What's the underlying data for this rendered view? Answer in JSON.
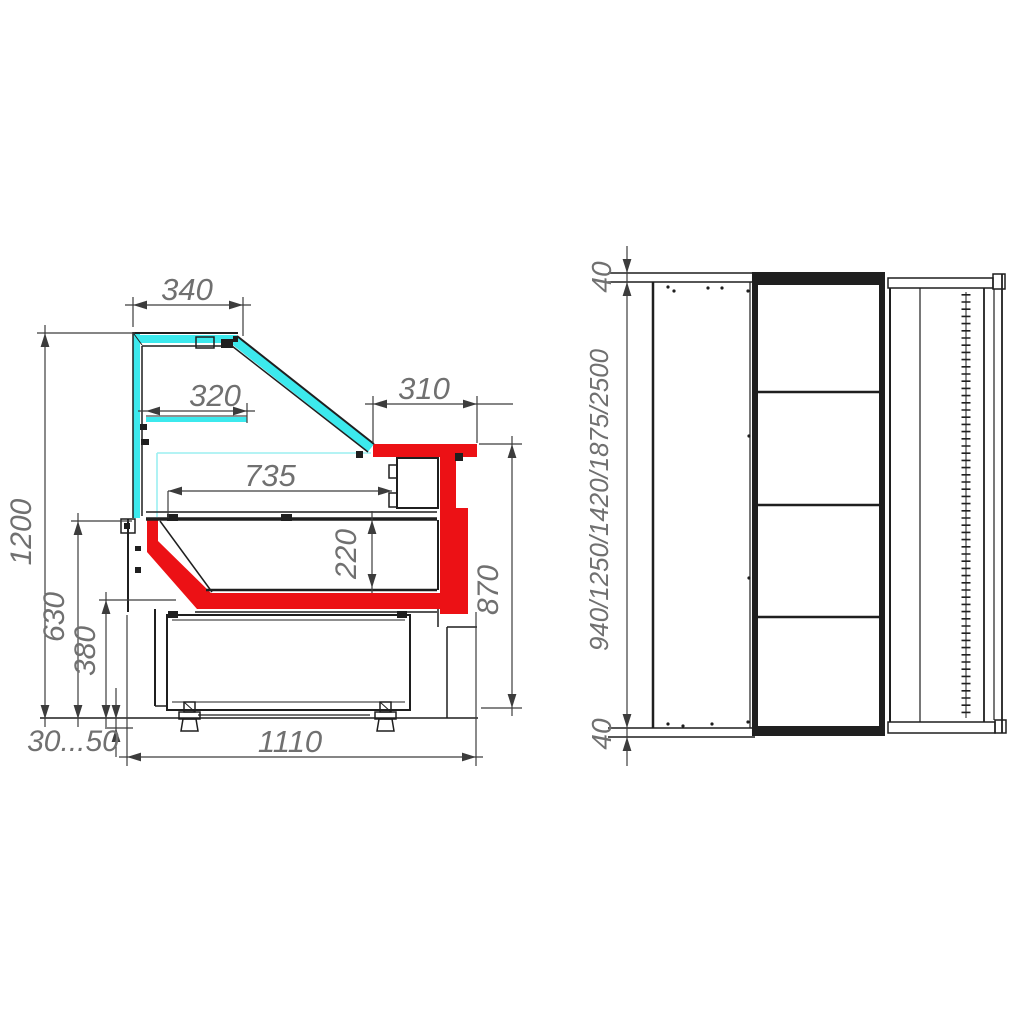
{
  "page": {
    "background": "#ffffff"
  },
  "colors": {
    "accent_red": "#ec1115",
    "glass_cyan": "#3ce9ed",
    "glass_cyan_light": "#9beff1",
    "line_black": "#1f1f1f",
    "dim_line": "#3c3c3c",
    "dim_text": "#707070"
  },
  "side_view": {
    "name": "cross-section view of display counter",
    "canopy_width": "340",
    "shelf_width": "320",
    "worktop_overhang": "310",
    "display_depth": "735",
    "well_depth": "220",
    "overall_height": "1200",
    "front_height": "630",
    "panel_height": "380",
    "worktop_height": "870",
    "leg_adjust_range": "30...50",
    "base_depth": "1110"
  },
  "plan_view": {
    "name": "plan view of display counter",
    "end_overhang_top": "40",
    "length_options": "940/1250/1420/1875/2500",
    "end_overhang_bottom": "40"
  }
}
